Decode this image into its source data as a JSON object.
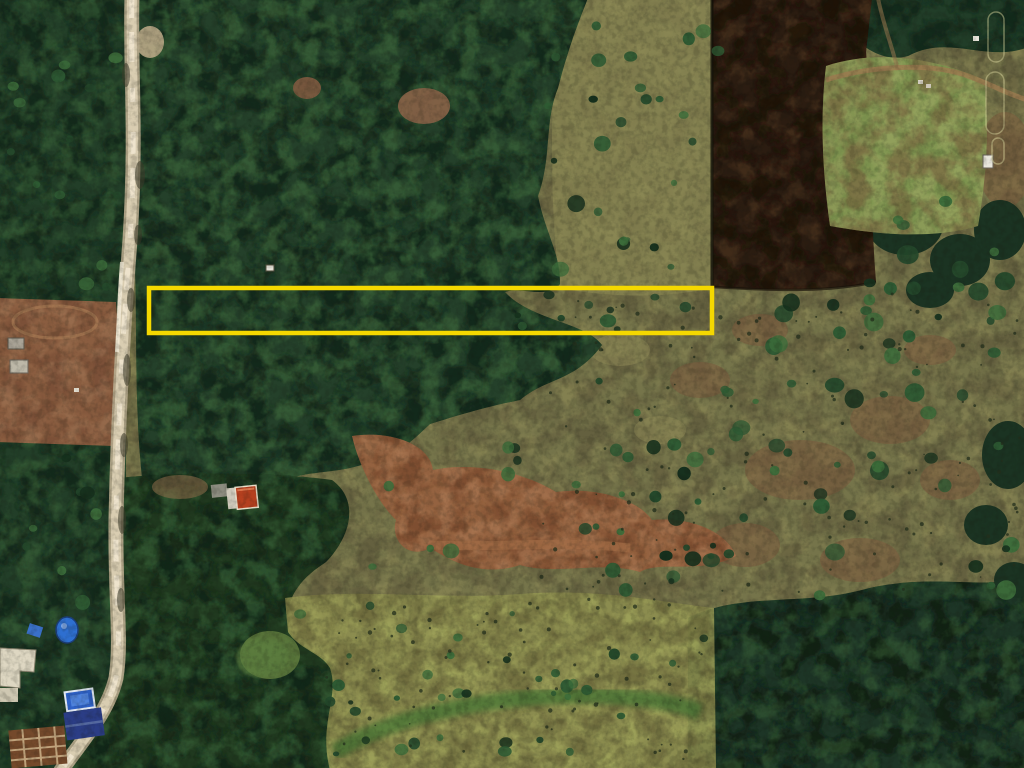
{
  "scene": {
    "description": "Aerial satellite view of rural land with a vertical dirt road, forest canopy, grassland, plowed field and small buildings; a yellow rectangle highlights a narrow parcel.",
    "regions": [
      {
        "name": "forest-canopy-upper",
        "color": "#24402a"
      },
      {
        "name": "roadside-tree-strip",
        "color": "#223e28"
      },
      {
        "name": "plowed-field-dark",
        "color": "#2b1c11"
      },
      {
        "name": "clearing-light-green",
        "color": "#94a35c"
      },
      {
        "name": "bare-earth-field",
        "color": "#8a5d40"
      },
      {
        "name": "grassland-east",
        "color": "#75744a"
      },
      {
        "name": "dirt-track-band",
        "color": "#96613f"
      },
      {
        "name": "meadow-south",
        "color": "#8f9150"
      },
      {
        "name": "forest-southeast",
        "color": "#1d3526"
      },
      {
        "name": "forest-south-central",
        "color": "#20391f"
      }
    ],
    "palette": {
      "grass_base": "#75744a",
      "grass_light": "#8f8a57",
      "grass_brown": "#7c5a3e",
      "canopy_base": "#24402a",
      "canopy_dark": "#0e2015",
      "canopy_light": "#3f6b3c",
      "canopy_deep": "#1b3322",
      "field_dark": "#2b1c11",
      "field_dark_streak": "#553a22",
      "clearing_green": "#94a35c",
      "bare_field": "#8a5d40",
      "dirt": "#96613f",
      "bright_band": "#3f7233",
      "grain": "#141810"
    }
  },
  "annotation": {
    "label": "parcel-outline",
    "shape": "rectangle",
    "x": 149,
    "y": 288,
    "width": 563,
    "height": 45,
    "stroke": "#F5D800",
    "stroke_width": 4.5
  },
  "road": {
    "name": "rural-road",
    "shoulder_color": "#b3a78a",
    "surface_color": "#d9cdb1",
    "bright_color": "#efe6cf",
    "shadow_color": "#3c3a2a"
  },
  "tracks": {
    "ne_path_color": "#9c7a50",
    "faint_marks_color": "#d8d49c",
    "field_loop_color": "#a87a54"
  },
  "structures": [
    {
      "name": "white-farm-building",
      "color": "#ded7c2"
    },
    {
      "name": "swimming-pool",
      "color": "#2f62c8"
    },
    {
      "name": "navy-roof-house",
      "color": "#2b3d85"
    },
    {
      "name": "construction-framing",
      "color": "#74492b"
    },
    {
      "name": "blue-tarp-umbrella",
      "color": "#2e6fd0"
    },
    {
      "name": "blue-tarp-small",
      "color": "#3a70c8"
    },
    {
      "name": "red-roof-house",
      "color": "#b5401f"
    },
    {
      "name": "white-shed-mid",
      "color": "#cfcabb"
    },
    {
      "name": "gray-shed",
      "color": "#8d8d80"
    },
    {
      "name": "field-shed-a",
      "color": "#a9a396"
    },
    {
      "name": "field-shed-b",
      "color": "#bdb8a8"
    },
    {
      "name": "white-structure-east",
      "color": "#e9e6dc"
    }
  ]
}
